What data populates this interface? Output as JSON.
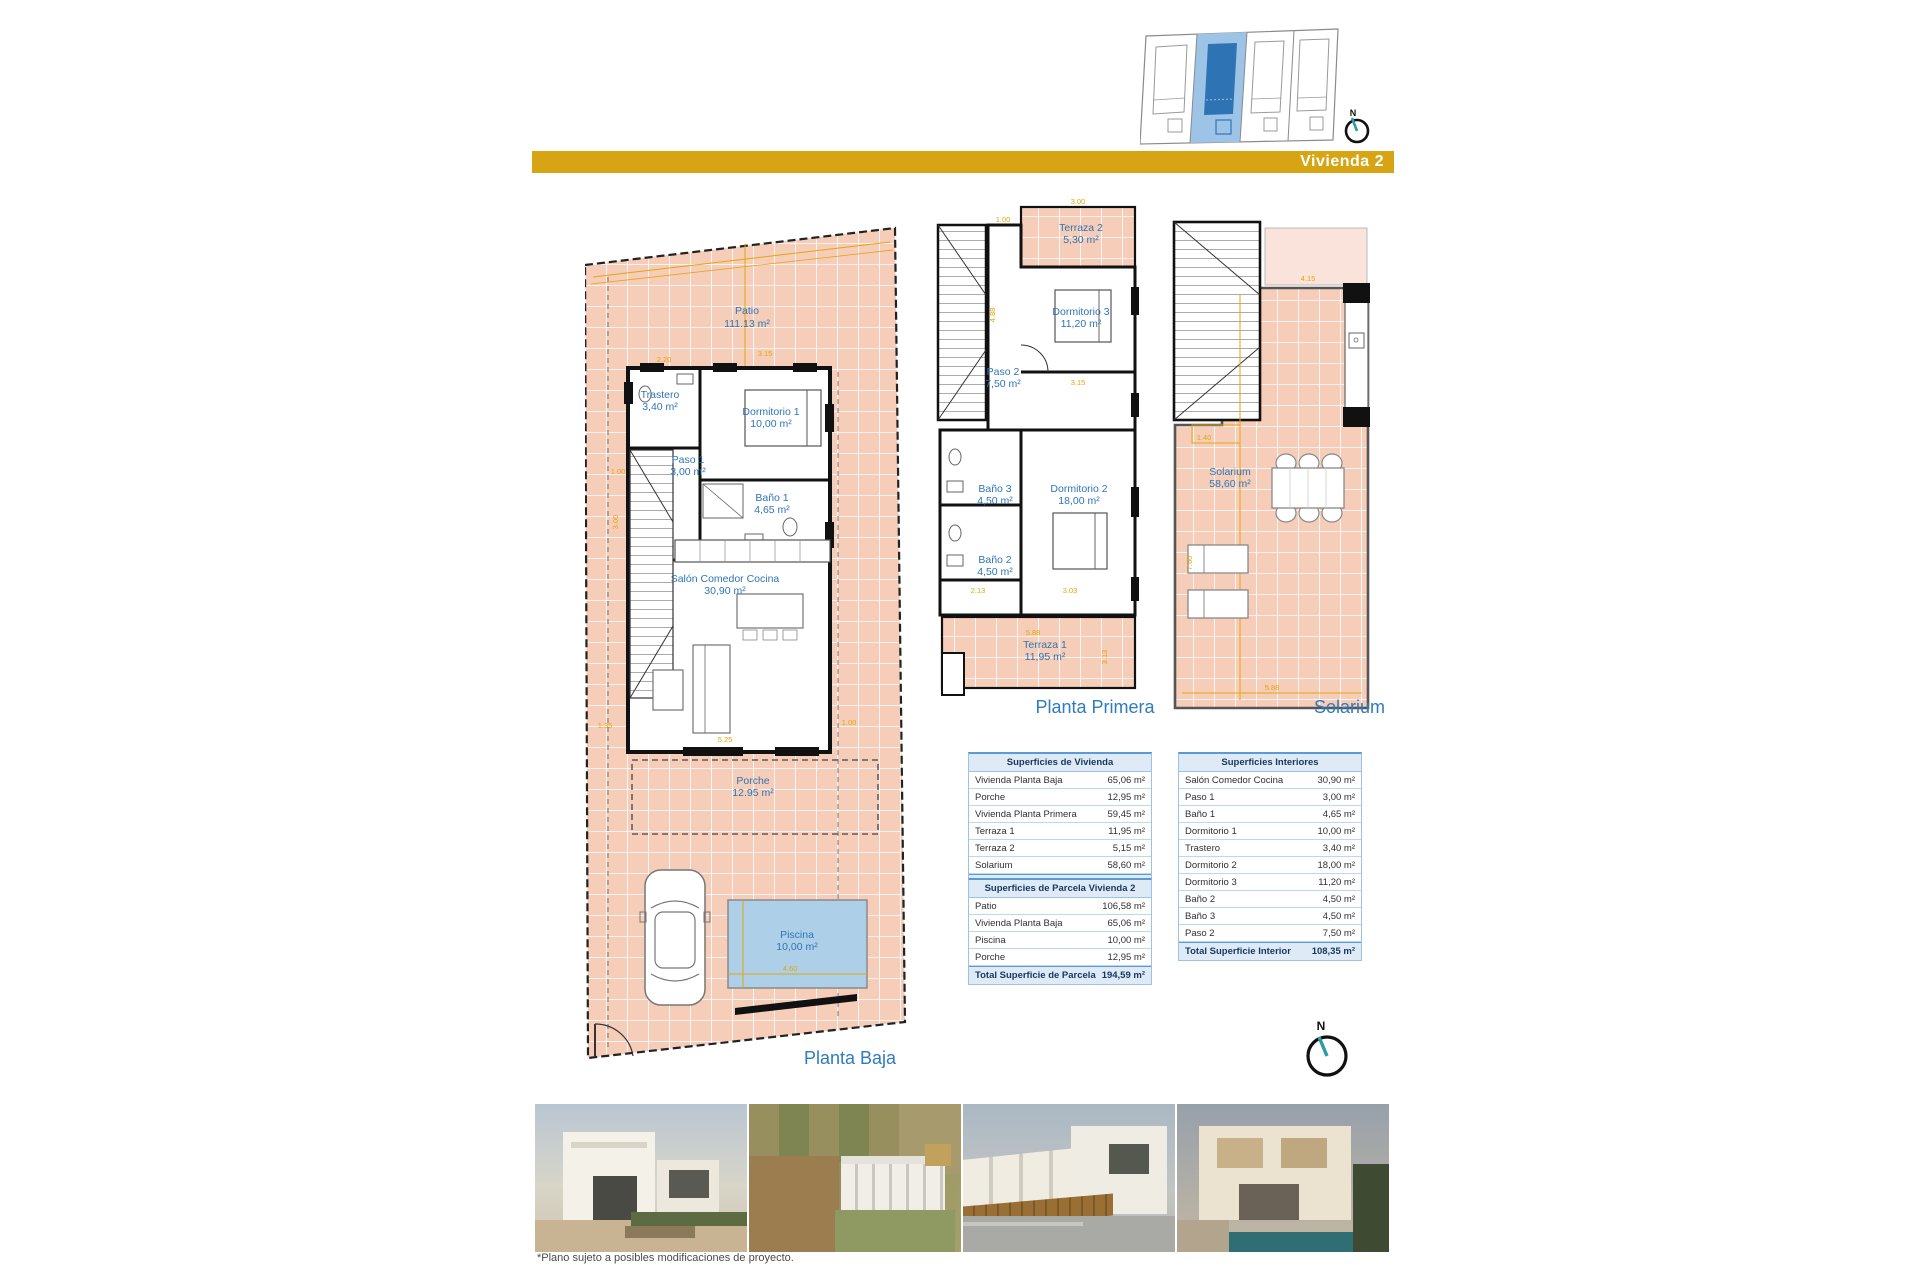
{
  "header": {
    "title": "Vivienda 2"
  },
  "compass": {
    "n": "N"
  },
  "plans": {
    "planta_baja": {
      "label": "Planta Baja",
      "patio": {
        "name": "Patio",
        "area": "111.13 m²"
      },
      "trastero": {
        "name": "Trastero",
        "area": "3,40 m²"
      },
      "dormitorio1": {
        "name": "Dormitorio 1",
        "area": "10,00 m²"
      },
      "paso1": {
        "name": "Paso 1",
        "area": "3,00 m²"
      },
      "bano1": {
        "name": "Baño 1",
        "area": "4,65 m²"
      },
      "salon": {
        "name": "Salón Comedor Cocina",
        "area": "30,90 m²"
      },
      "porche": {
        "name": "Porche",
        "area": "12.95 m²"
      },
      "piscina": {
        "name": "Piscina",
        "area": "10,00 m²"
      },
      "dims": [
        "2.20",
        "3.15",
        "1.00",
        "3.00",
        "5.25",
        "1.35",
        "1.00",
        "4.60"
      ]
    },
    "planta_primera": {
      "label": "Planta Primera",
      "terraza2": {
        "name": "Terraza 2",
        "area": "5,30 m²"
      },
      "dormitorio3": {
        "name": "Dormitorio 3",
        "area": "11,20 m²"
      },
      "paso2": {
        "name": "Paso 2",
        "area": "7,50 m²"
      },
      "bano3": {
        "name": "Baño 3",
        "area": "4,50 m²"
      },
      "dormitorio2": {
        "name": "Dormitorio 2",
        "area": "18,00 m²"
      },
      "bano2": {
        "name": "Baño 2",
        "area": "4,50 m²"
      },
      "terraza1": {
        "name": "Terraza 1",
        "area": "11,95 m²"
      },
      "dims": [
        "3.00",
        "1.00",
        "4.88",
        "3.15",
        "2.13",
        "3.03",
        "5.88",
        "3.13"
      ]
    },
    "solarium": {
      "label": "Solarium",
      "room": {
        "name": "Solarium",
        "area": "58,60 m²"
      },
      "dims": [
        "4.15",
        "1.40",
        "7.60",
        "5.88"
      ]
    }
  },
  "tables": {
    "vivienda": {
      "title": "Superficies de Vivienda",
      "rows": [
        {
          "label": "Vivienda Planta Baja",
          "value": "65,06 m²"
        },
        {
          "label": "Porche",
          "value": "12,95 m²"
        },
        {
          "label": "Vivienda Planta Primera",
          "value": "59,45 m²"
        },
        {
          "label": "Terraza 1",
          "value": "11,95 m²"
        },
        {
          "label": "Terraza 2",
          "value": "5,15 m²"
        },
        {
          "label": "Solarium",
          "value": "58,60 m²"
        }
      ],
      "total": {
        "label": "Total Superficie Vivienda",
        "value": "213,16 m²"
      }
    },
    "parcela": {
      "title": "Superficies de Parcela Vivienda 2",
      "rows": [
        {
          "label": "Patio",
          "value": "106,58 m²"
        },
        {
          "label": "Vivienda Planta Baja",
          "value": "65,06 m²"
        },
        {
          "label": "Piscina",
          "value": "10,00 m²"
        },
        {
          "label": "Porche",
          "value": "12,95 m²"
        }
      ],
      "total": {
        "label": "Total Superficie de Parcela",
        "value": "194,59 m²"
      }
    },
    "interiores": {
      "title": "Superficies Interiores",
      "rows": [
        {
          "label": "Salón Comedor Cocina",
          "value": "30,90 m²"
        },
        {
          "label": "Paso 1",
          "value": "3,00 m²"
        },
        {
          "label": "Baño 1",
          "value": "4,65 m²"
        },
        {
          "label": "Dormitorio 1",
          "value": "10,00 m²"
        },
        {
          "label": "Trastero",
          "value": "3,40 m²"
        },
        {
          "label": "Dormitorio 2",
          "value": "18,00 m²"
        },
        {
          "label": "Dormitorio 3",
          "value": "11,20 m²"
        },
        {
          "label": "Baño 2",
          "value": "4,50 m²"
        },
        {
          "label": "Baño 3",
          "value": "4,50 m²"
        },
        {
          "label": "Paso 2",
          "value": "7,50 m²"
        }
      ],
      "total": {
        "label": "Total Superficie Interior",
        "value": "108,35 m²"
      }
    }
  },
  "footer": {
    "fine_print": "*Plano sujeto a posibles modificaciones de proyecto."
  },
  "colors": {
    "accent_gold": "#D7A413",
    "label_blue": "#2E75B6",
    "dim_yellow": "#E2A60D",
    "floor_salmon": "#F6CDB9",
    "pool_blue": "#AECFE8",
    "table_accent": "#DEEBF7",
    "siteplan_highlight_light": "#9DC3E6",
    "siteplan_highlight_dark": "#2E74B5"
  }
}
